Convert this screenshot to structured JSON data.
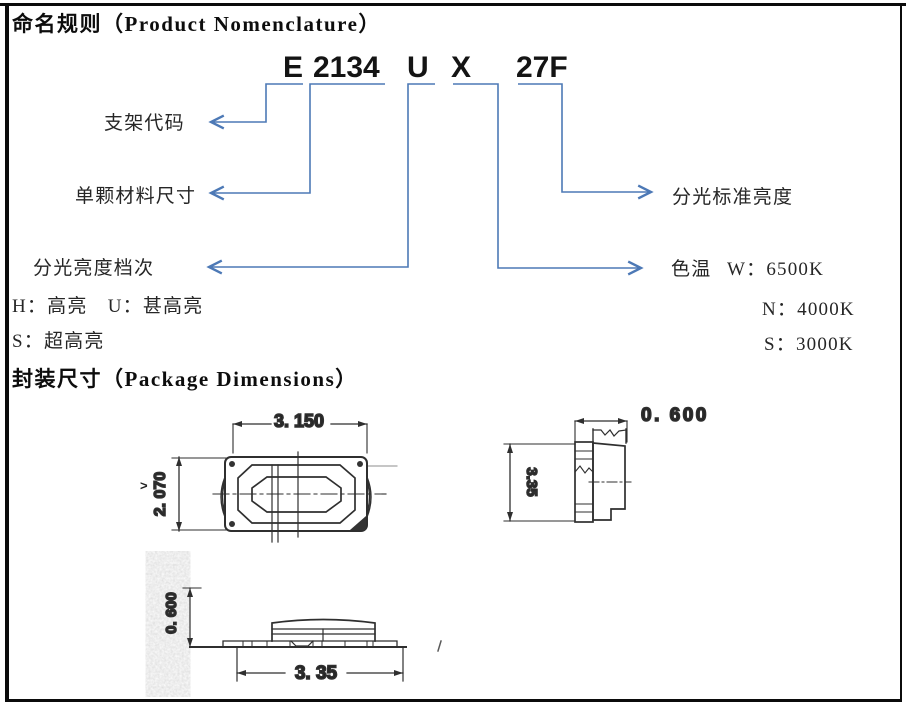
{
  "headings": {
    "nomenclature": "命名规则（Product Nomenclature）",
    "package": "封装尺寸（Package Dimensions）"
  },
  "code": {
    "parts": [
      "E",
      "2134",
      "U",
      "X",
      "27F"
    ]
  },
  "labels": {
    "bracket_code": "支架代码",
    "material_size": "单颗材料尺寸",
    "brightness_grade": "分光亮度档次",
    "brightness_legend_row1": "H：高亮　U：甚高亮",
    "brightness_legend_row2": "S：超高亮",
    "standard_brightness": "分光标准亮度",
    "color_temp": "色温",
    "color_temp_w": "W：6500K",
    "color_temp_n": "N：4000K",
    "color_temp_s": "S：3000K"
  },
  "drawing": {
    "top_view_width": "3. 150",
    "top_view_height": "2. 070",
    "side_view_width": "0. 600",
    "side_view_height": "3.35",
    "front_view_height": "0. 600",
    "front_view_width": "3. 35",
    "pointer_mark": ">"
  },
  "colors": {
    "connector_blue": "#4d79b6",
    "drawing_ink": "#2f2f2f"
  }
}
